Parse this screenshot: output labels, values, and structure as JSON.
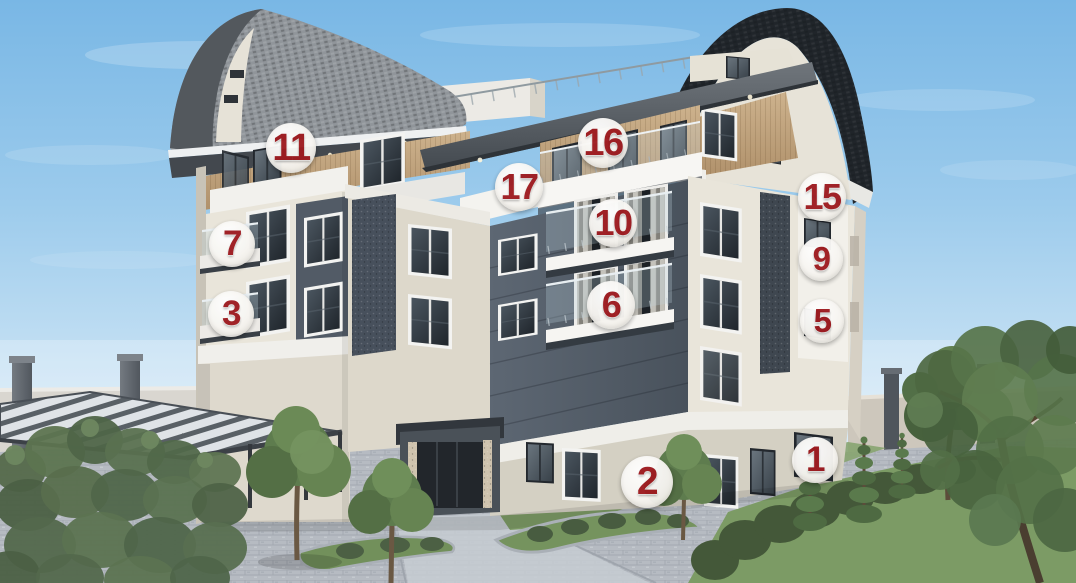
{
  "scene": {
    "description": "3D architectural rendering of a multi-storey residential building with numbered apartment unit markers",
    "sky_color": "#8fc3ea",
    "facade_colors": {
      "cream": "#e9e5da",
      "dark_panel": "#5b6571",
      "wood": "#c3a67f",
      "roof_dark": "#20252a",
      "white_trim": "#f2f1ed"
    },
    "marker_style": {
      "circle_color": "#f6f4f0",
      "number_color": "#9e1b20"
    }
  },
  "unit_markers": [
    {
      "number": "11",
      "x": 291,
      "y": 148,
      "r": 25
    },
    {
      "number": "16",
      "x": 603,
      "y": 143,
      "r": 25
    },
    {
      "number": "17",
      "x": 519,
      "y": 187,
      "r": 24
    },
    {
      "number": "15",
      "x": 822,
      "y": 197,
      "r": 24
    },
    {
      "number": "10",
      "x": 613,
      "y": 223,
      "r": 24
    },
    {
      "number": "7",
      "x": 232,
      "y": 244,
      "r": 23
    },
    {
      "number": "9",
      "x": 821,
      "y": 259,
      "r": 22
    },
    {
      "number": "6",
      "x": 611,
      "y": 305,
      "r": 24
    },
    {
      "number": "3",
      "x": 231,
      "y": 314,
      "r": 23
    },
    {
      "number": "5",
      "x": 822,
      "y": 321,
      "r": 22
    },
    {
      "number": "1",
      "x": 815,
      "y": 460,
      "r": 23
    },
    {
      "number": "2",
      "x": 647,
      "y": 482,
      "r": 26
    }
  ]
}
